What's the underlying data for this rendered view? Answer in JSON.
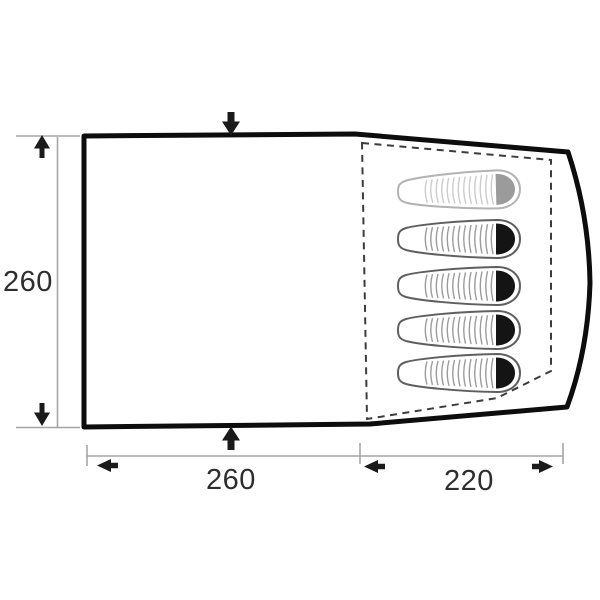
{
  "diagram": {
    "kind": "tent-floorplan-top-view",
    "background_color": "#ffffff",
    "tent_outline_color": "#0d0d0d",
    "inner_tent_dash_color": "#3c3c3c",
    "dimension_line_color": "#a6a6a6",
    "dimension_text_color": "#2e2e2e",
    "arrow_color": "#1a1a1a",
    "dimensions": {
      "left_height": "260",
      "bottom_left_width": "260",
      "bottom_right_width": "220"
    },
    "icons": {
      "left_dim_top": "arrow-up-icon",
      "left_dim_bottom": "arrow-down-icon",
      "top_door": "arrow-down-icon",
      "bottom_door": "arrow-up-icon",
      "bottom_dim_left": "arrow-left-icon",
      "bottom_dim_middle": "arrow-left-icon",
      "bottom_dim_right": "arrow-right-icon"
    },
    "sleeping_area": {
      "bag_count": 5,
      "free_bag_head_color": "#9b9b9b",
      "occupied_bag_head_color": "#141414",
      "bags": [
        {
          "state": "free"
        },
        {
          "state": "occupied"
        },
        {
          "state": "occupied"
        },
        {
          "state": "occupied"
        },
        {
          "state": "occupied"
        }
      ]
    }
  }
}
